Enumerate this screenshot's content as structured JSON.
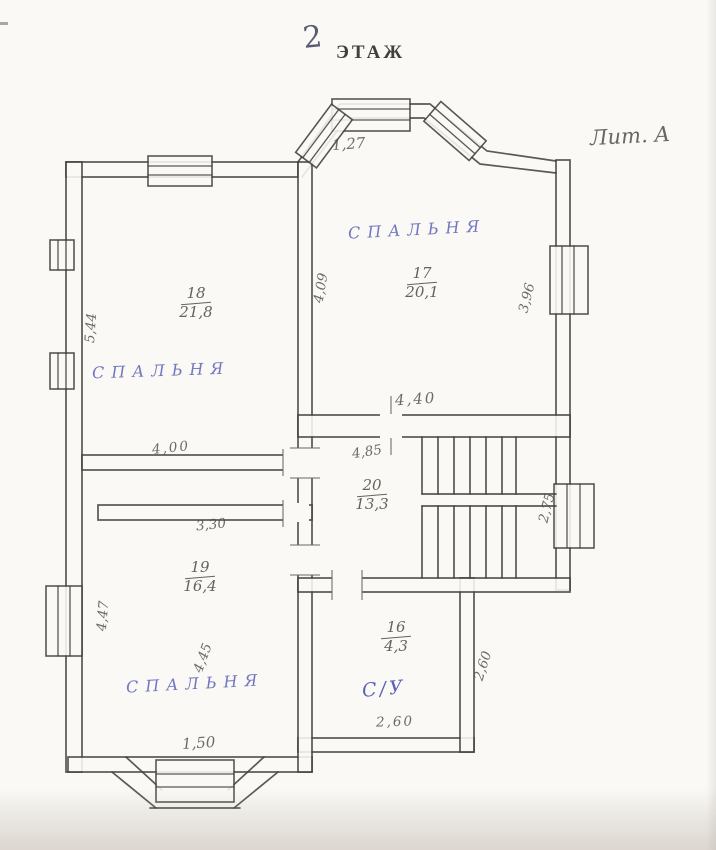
{
  "page": {
    "title_number": "2",
    "title_word": "ЭТАЖ",
    "liter": "Лит. А"
  },
  "rooms": {
    "bedroom_top_left": {
      "label": "СПАЛЬНЯ",
      "number": "18",
      "area": "21,8"
    },
    "bedroom_top_right": {
      "label": "СПАЛЬНЯ",
      "number": "17",
      "area": "20,1"
    },
    "bedroom_bottom_left": {
      "label": "СПАЛЬНЯ",
      "number": "19",
      "area": "16,4"
    },
    "stair_hall": {
      "number": "20",
      "area": "13,3"
    },
    "bathroom": {
      "label": "С/У",
      "number": "16",
      "area": "4,3"
    }
  },
  "dimensions": {
    "bay_window_top": "1,27",
    "left_wall_upper": "5,44",
    "partition_upper": "4,09",
    "right_wall_upper": "3,96",
    "bedroom_right_width": "4,40",
    "stair_hall_width": "4,85",
    "bedroom_left_width": "4,00",
    "stair_landing_depth": "2,75",
    "bedroom_bottom_width_top": "3,30",
    "bedroom_bottom_left_wall": "4,47",
    "bedroom_bottom_height": "4,45",
    "bay_window_bottom": "1,50",
    "bathroom_depth": "2,60",
    "bathroom_width": "2,60"
  },
  "colors": {
    "ink": "#45413b",
    "pencil": "#57524b",
    "blue_pen": "#5a61b8",
    "paper": "#faf9f5"
  }
}
